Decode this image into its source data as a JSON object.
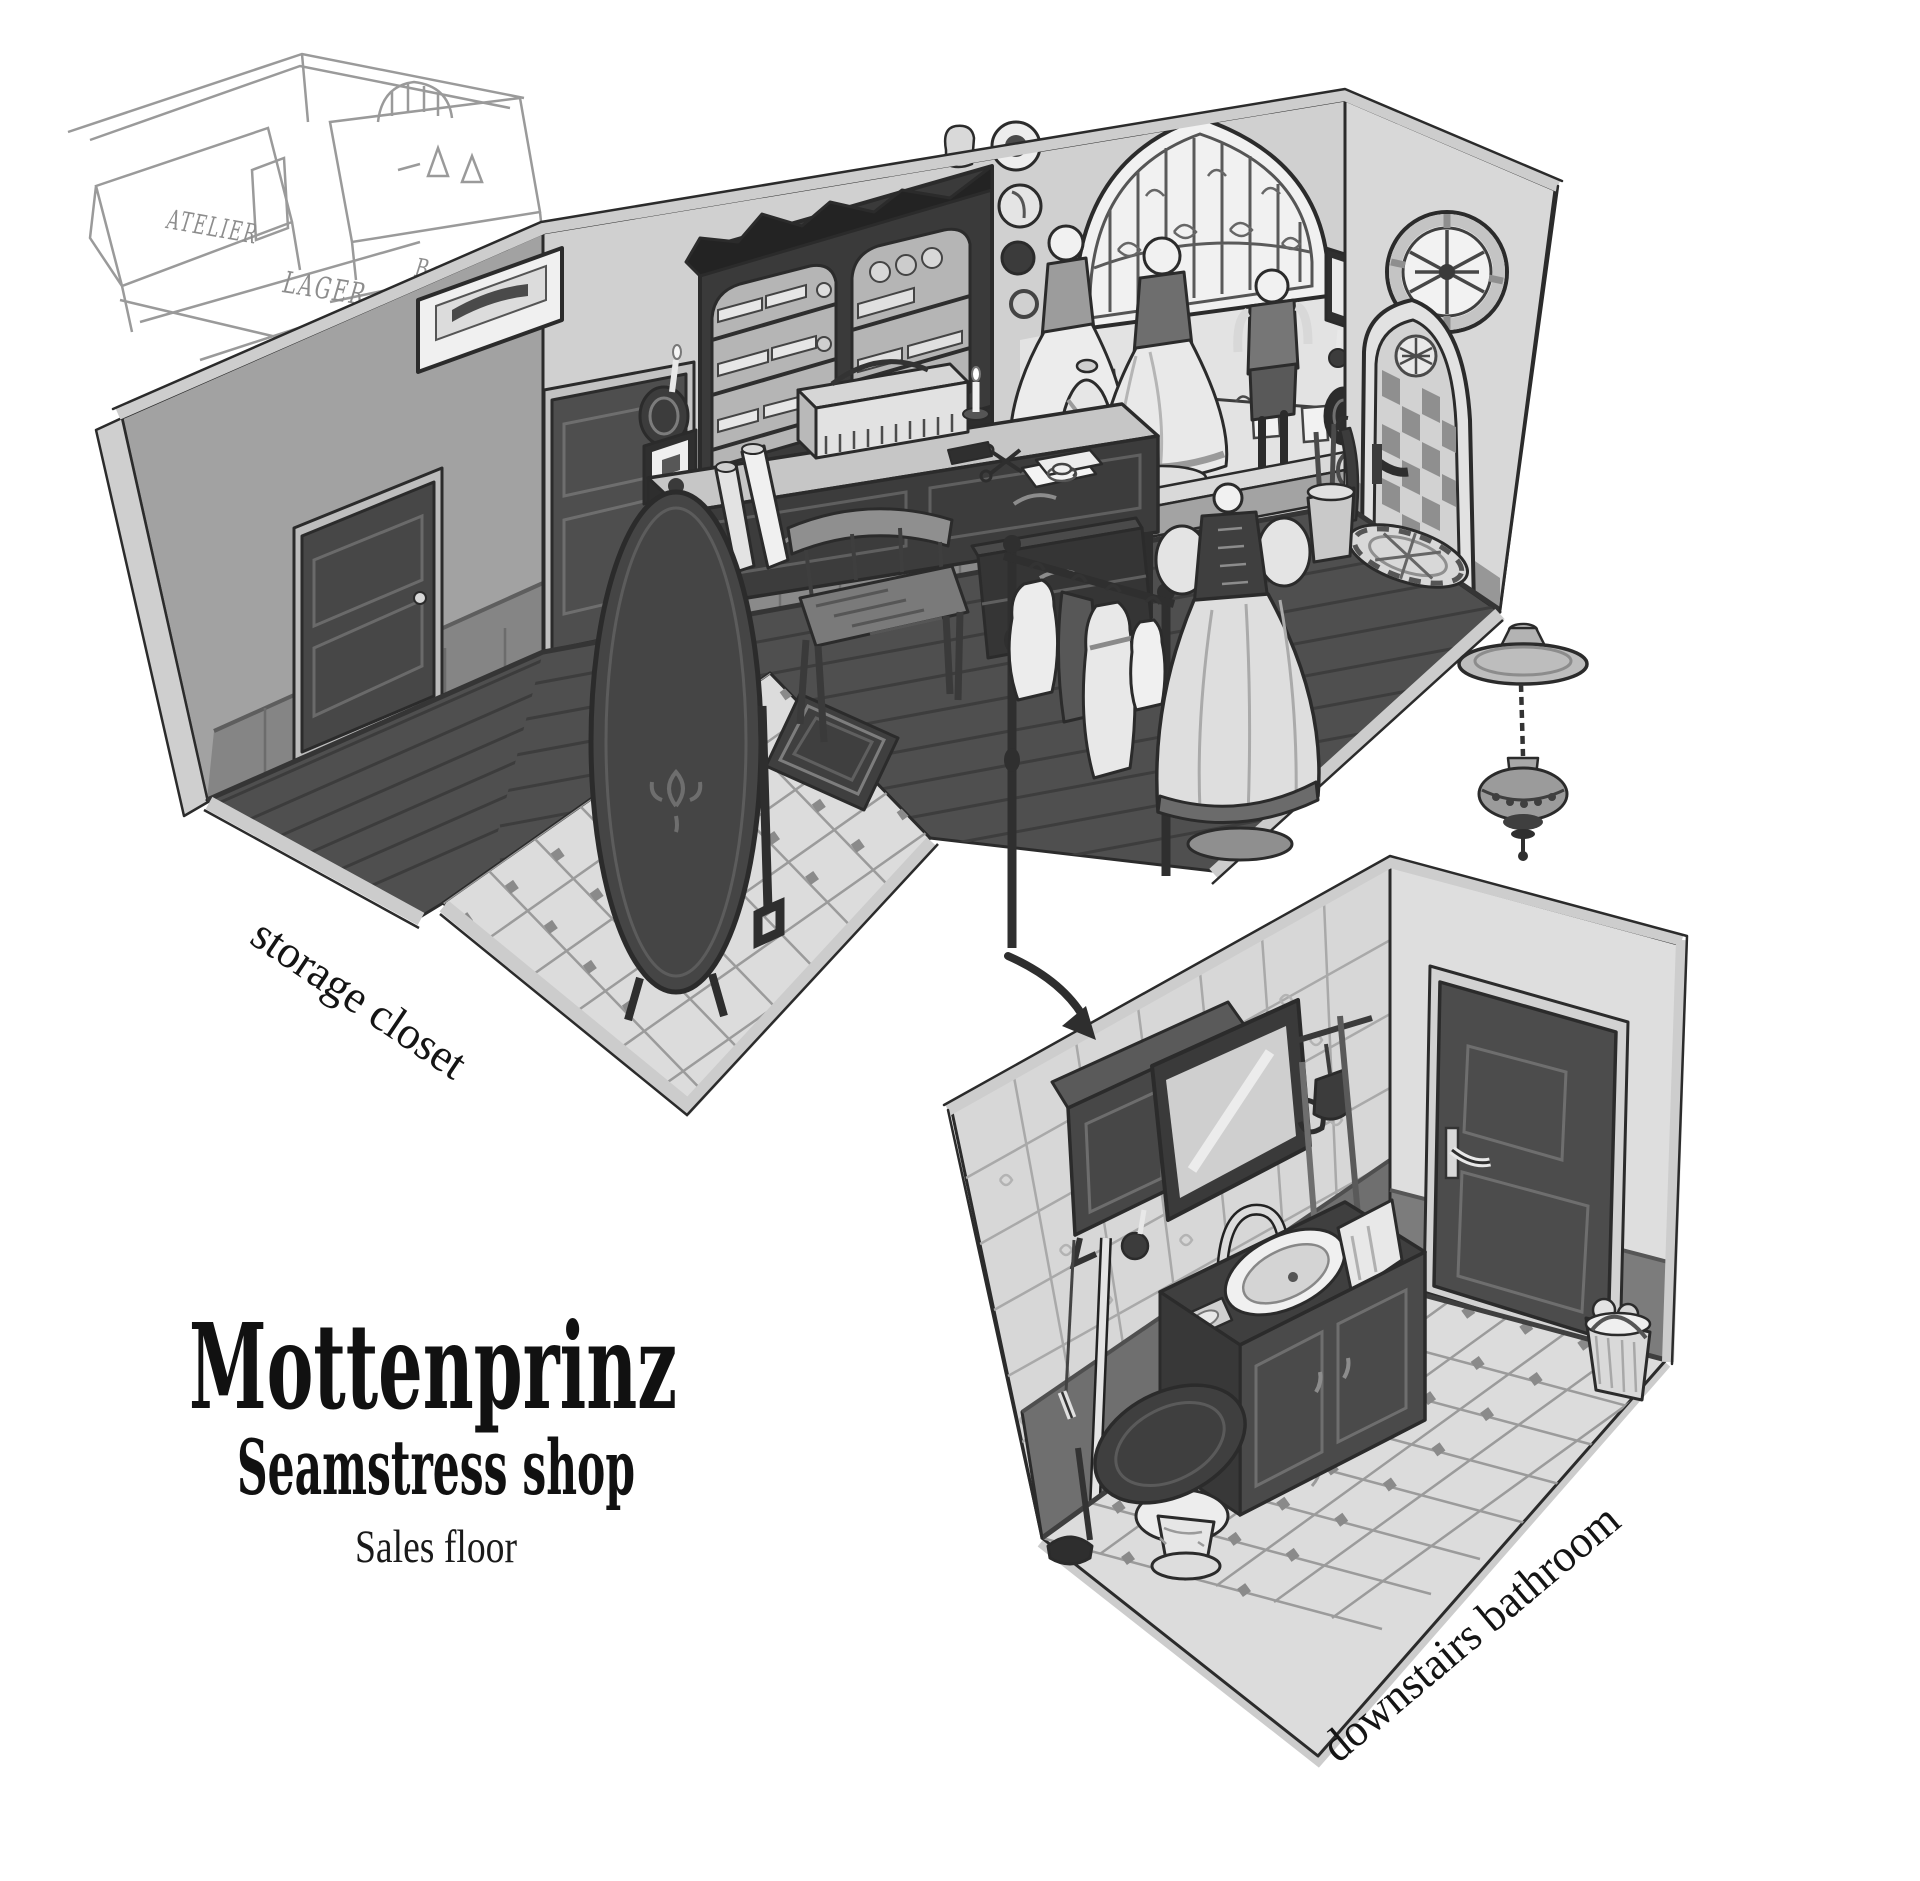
{
  "title": {
    "shop_name": "Mottenprinz",
    "shop_type": "Seamstress shop",
    "floor_label": "Sales floor"
  },
  "annotations": {
    "storage_closet": "storage closet",
    "downstairs_bathroom": "downstairs bathroom"
  },
  "sketch_labels": {
    "atelier": "ATELIER",
    "lager": "LAGER",
    "bath": "Bath"
  },
  "palette": {
    "paper": "#ffffff",
    "ink": "#2b2b2b",
    "wall_light": "#d2d2d2",
    "wall_mid": "#a6a6a6",
    "wainscot": "#868686",
    "wainscot_dark": "#6f6f6f",
    "wood_dark": "#3a3a3a",
    "door_dark": "#4e4e4e",
    "floor_wood": "#4f4f4f",
    "tile_light": "#dcdcdc",
    "tile_grout": "#9b9b9b",
    "tile_accent": "#8a8a8a",
    "edge_light": "#cfcfcf"
  },
  "scene": {
    "sales_floor_objects": [
      "fabric hutch cabinet",
      "arched shop window with iron grille",
      "three display mannequins",
      "card garland",
      "sewing desk",
      "sewing box",
      "tailors bust",
      "chair",
      "standing oval mirror",
      "fabric rolls",
      "drawer chest",
      "clothes rack with garments",
      "dress form mannequin",
      "umbrella stand",
      "rug",
      "tiled entry floor",
      "arched entry door with checkered glass",
      "round window",
      "doormat",
      "wall plates",
      "candle sconces",
      "framed pictures",
      "storage closet door"
    ],
    "bathroom_objects": [
      "tiled wall with floral tiles",
      "high toilet cistern with pull chain",
      "tilted mirror",
      "candle sconce",
      "gooseneck faucet",
      "sink vanity cabinet",
      "soap dish",
      "towel",
      "broom",
      "mop",
      "dust pan",
      "toilet",
      "plunger",
      "cleaning bucket",
      "panel door",
      "octagon tile floor"
    ],
    "other_objects": [
      "hanging lamp",
      "connection arrow",
      "concept thumbnail sketch"
    ]
  }
}
